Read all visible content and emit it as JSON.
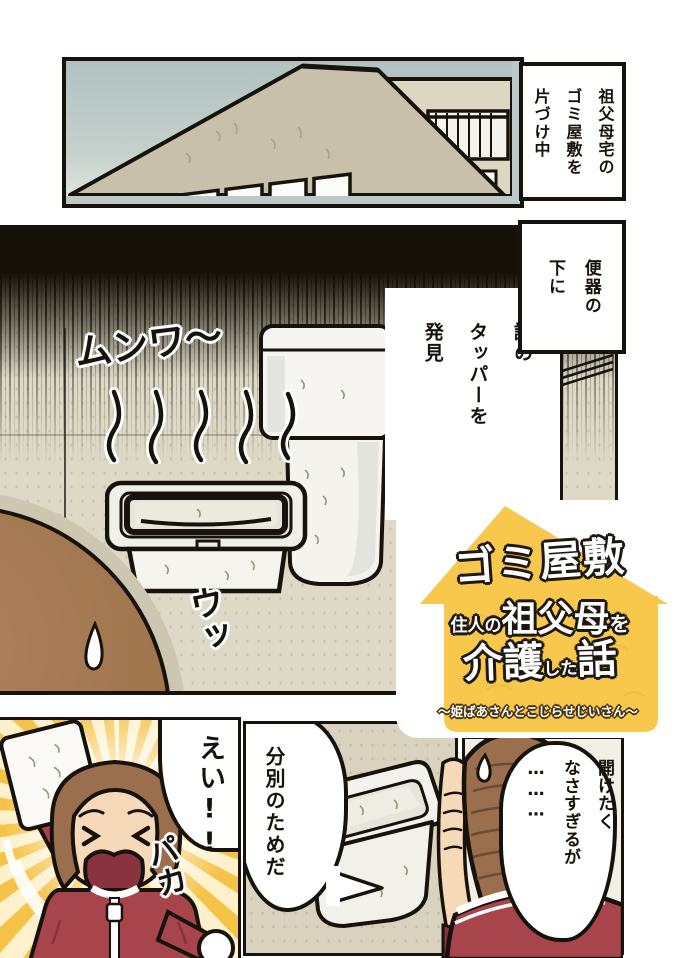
{
  "panels": {
    "top": {
      "narration": "祖父母宅の\nゴミ屋敷を\n片づけ中"
    },
    "main": {
      "narration_toilet": "便器の\n下に",
      "narration_discovery": "謎の\nタッパーを\n発見",
      "sfx_smell": "ムンワ〜",
      "sfx_groan": "ウッ"
    },
    "bottom_left": {
      "shout": "えい!!",
      "sfx_open": "パカ"
    },
    "bottom_middle": {
      "speech": "分別のためだ"
    },
    "bottom_right": {
      "speech": "開けたく\nなさすぎるが\n………"
    }
  },
  "logo": {
    "line1": "ゴミ屋敷",
    "line2_prefix": "住人の",
    "line2_main": "祖父母",
    "line2_suffix": "を",
    "line3_main1": "介護",
    "line3_mid": "した",
    "line3_main2": "話",
    "subtitle": "〜姫ばあさんとこじらせじいさん〜"
  },
  "colors": {
    "logo_yellow": "#f7c84b",
    "jacket_red": "#a8454c",
    "hair_brown": "#9b6f4d",
    "skin": "#f6d9b8",
    "wall_beige": "#ded8c7",
    "sky": "#b9c7c6",
    "ink": "#17130c"
  }
}
